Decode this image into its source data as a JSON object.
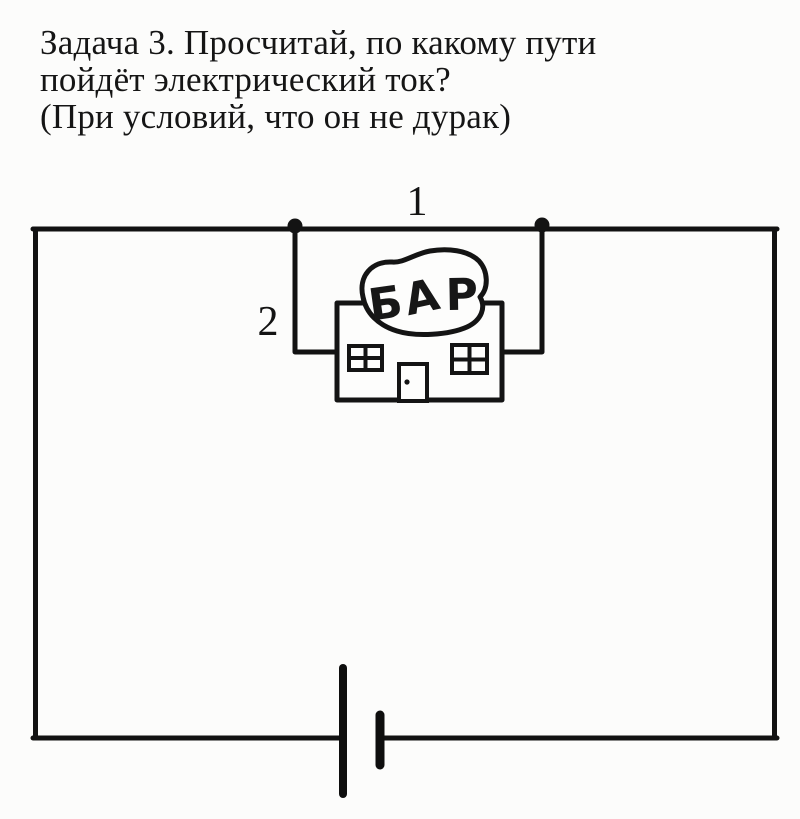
{
  "title": {
    "line1": "Задача 3. Просчитай, по какому пути",
    "line2": "пойдёт электрический ток?",
    "line3": "(При условий, что он не дурак)"
  },
  "circuit": {
    "path1_label": "1",
    "path2_label": "2",
    "bar_sign": "БАР"
  },
  "colors": {
    "background": "#fcfcfb",
    "ink": "#141414"
  }
}
